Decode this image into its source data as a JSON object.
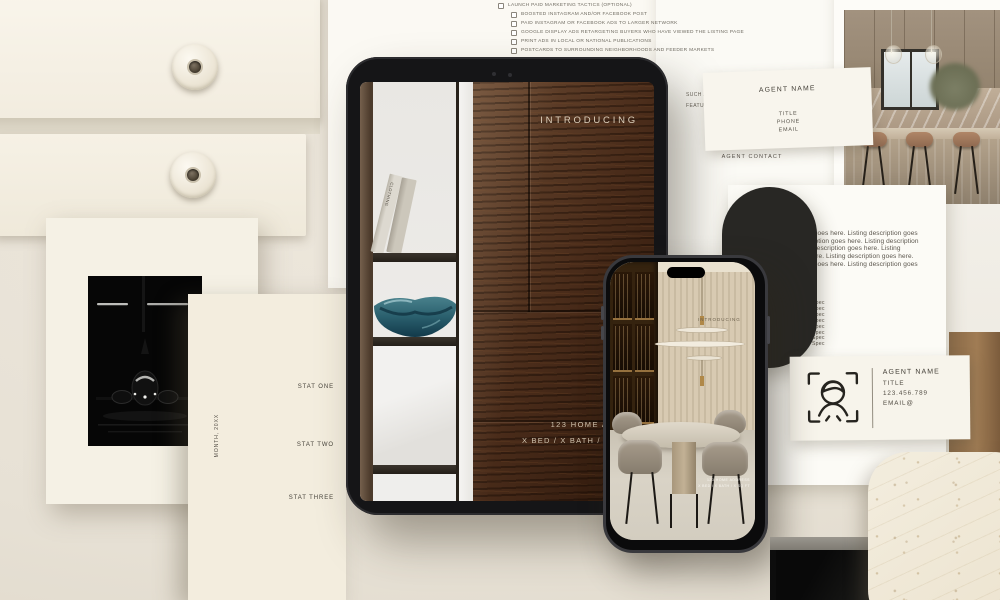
{
  "colors": {
    "background": "#e8e2d7",
    "paper_white": "#fbfaf5",
    "paper_cream": "#f3edde",
    "ink": "#55504a",
    "wood_dark": "#3c2817",
    "accent_teal": "#2f6572",
    "device_black": "#151517",
    "pill_black": "#282724",
    "headline_cream": "#dccfbb"
  },
  "checklist": {
    "items": [
      {
        "label": "LAUNCH PAID MARKETING TACTICS (OPTIONAL)",
        "indent": 0
      },
      {
        "label": "BOOSTED INSTAGRAM AND/OR FACEBOOK POST",
        "indent": 1
      },
      {
        "label": "PAID INSTAGRAM OR FACEBOOK ADS TO LARGER NETWORK",
        "indent": 1
      },
      {
        "label": "GOOGLE DISPLAY ADS RETARGETING BUYERS WHO HAVE VIEWED THE LISTING PAGE",
        "indent": 1
      },
      {
        "label": "PRINT ADS IN LOCAL OR NATIONAL PUBLICATIONS",
        "indent": 1
      },
      {
        "label": "POSTCARDS TO SURROUNDING NEIGHBORHOODS AND FEEDER MARKETS",
        "indent": 1
      },
      {
        "label": "SCHEDULE & HOST A BROKER OPEN HOUSE",
        "indent": 0
      },
      {
        "label": "SCHEDULE & HOST AN OPEN HOUSE",
        "indent": 0
      }
    ]
  },
  "agent_contact_page": {
    "heading": "AGENT CONTACT",
    "fragment_line1": "SUCH AS VIRT",
    "fragment_line2": "FEATURES AN"
  },
  "agent_card_top": {
    "name": "AGENT NAME",
    "title": "TITLE",
    "phone": "PHONE",
    "email": "EMAIL"
  },
  "ipad_screen": {
    "headline": "INTRODUCING",
    "address": "123 HOME ADDRESS",
    "specs": "X BED / X BATH / X SQ FT /",
    "book_spine": "CLOTHING"
  },
  "phone_screen": {
    "headline": "INTRODUCING",
    "address": "123 HOME ADDRESS",
    "specs": "X BED / X BATH / X SQ FT"
  },
  "listing_page": {
    "description": "Listing description goes here. Listing description goes here. Listing description goes here. Listing description goes here. Listing description goes here. Listing description goes here. Listing description goes here. Listing description goes here. Listing description goes here.",
    "spec_items": [
      "Spec",
      "Spec",
      "Spec",
      "Spec",
      "Spec",
      "Spec",
      "Spec",
      "Spec"
    ]
  },
  "agent_card_right": {
    "name": "AGENT NAME",
    "title": "TITLE",
    "phone": "123.456.789",
    "email": "EMAIL@"
  },
  "stats_page": {
    "stat_one": "STAT ONE",
    "stat_two": "STAT TWO",
    "stat_three": "STAT THREE",
    "date_label": "MONTH, 20XX"
  }
}
